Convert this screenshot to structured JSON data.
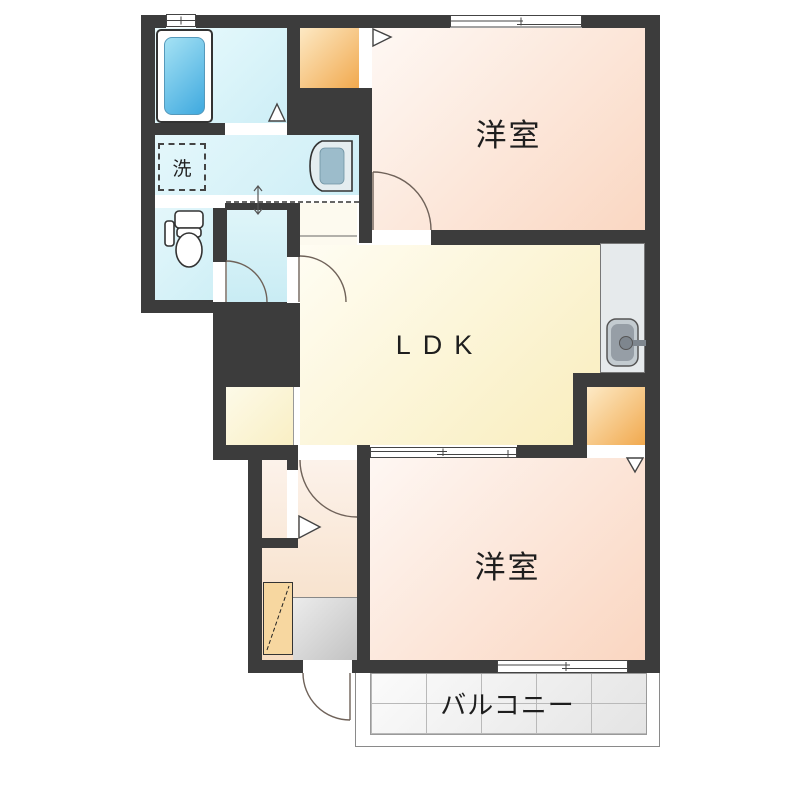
{
  "plan": {
    "rooms": {
      "bedroom_top": {
        "label": "洋室"
      },
      "bedroom_bottom": {
        "label": "洋室"
      },
      "ldk": {
        "label": "LDK"
      },
      "balcony": {
        "label": "バルコニー"
      },
      "laundry": {
        "label": "洗"
      }
    },
    "colors": {
      "wall": "#3c3c3c",
      "bedroom_peach": "#fad7c2",
      "ldk_yellow": "#f8ecb8",
      "wet_area_cyan": "#cdeef6",
      "closet_orange": "#f1a94e",
      "entrance_gray": "#c2c2c2",
      "bathtub_blue": "#3fa9df",
      "balcony_tile": "#e6e6e6"
    }
  }
}
